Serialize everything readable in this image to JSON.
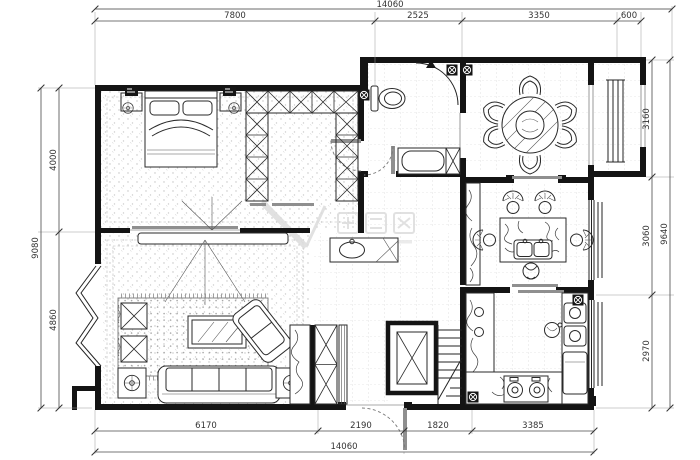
{
  "drawing": {
    "kind": "residential-floor-plan",
    "units": "mm",
    "colors": {
      "wall": "#141414",
      "line": "#2a2a2a",
      "dimension_text": "#333333",
      "tile_grid": "#cfcfcf",
      "floor_dots": "#c2c2c2",
      "door_slab": "#8f8f8f",
      "watermark": "#dcdcdc",
      "background": "#ffffff"
    }
  },
  "dims": {
    "top": {
      "total": "14060",
      "segments": [
        "7800",
        "2525",
        "3350",
        "600"
      ]
    },
    "bottom": {
      "total": "14060",
      "segments": [
        "6170",
        "2190",
        "1820",
        "3385"
      ]
    },
    "left": {
      "total": "9080",
      "segments": [
        "4000",
        "4860"
      ]
    },
    "right": {
      "total": "9640",
      "segments": [
        "3160",
        "3060",
        "2970"
      ]
    }
  },
  "icons": {
    "floor-drain": "boxed-circle-cross",
    "vent": "triangle",
    "lamp": "circle-cross",
    "wardrobe-cell": "x-box",
    "elevator": "x-box"
  },
  "furniture": [
    "double-bed",
    "nightstand",
    "wall-sconce",
    "wardrobe",
    "walk-in-closet",
    "toilet",
    "shower",
    "bathtub",
    "vanity-sink",
    "round-dining-table",
    "dining-chair",
    "island-table",
    "island-sink",
    "wicker-chair",
    "stool",
    "kitchen-counter",
    "kitchen-sink",
    "stove",
    "refrigerator",
    "tv-console",
    "rug",
    "ottoman",
    "coffee-table",
    "sofa",
    "side-table-lamp",
    "lounge-chair",
    "display-cabinet",
    "shoe-cabinet",
    "elevator",
    "staircase",
    "bay-window",
    "window",
    "entry-door",
    "sliding-door"
  ]
}
